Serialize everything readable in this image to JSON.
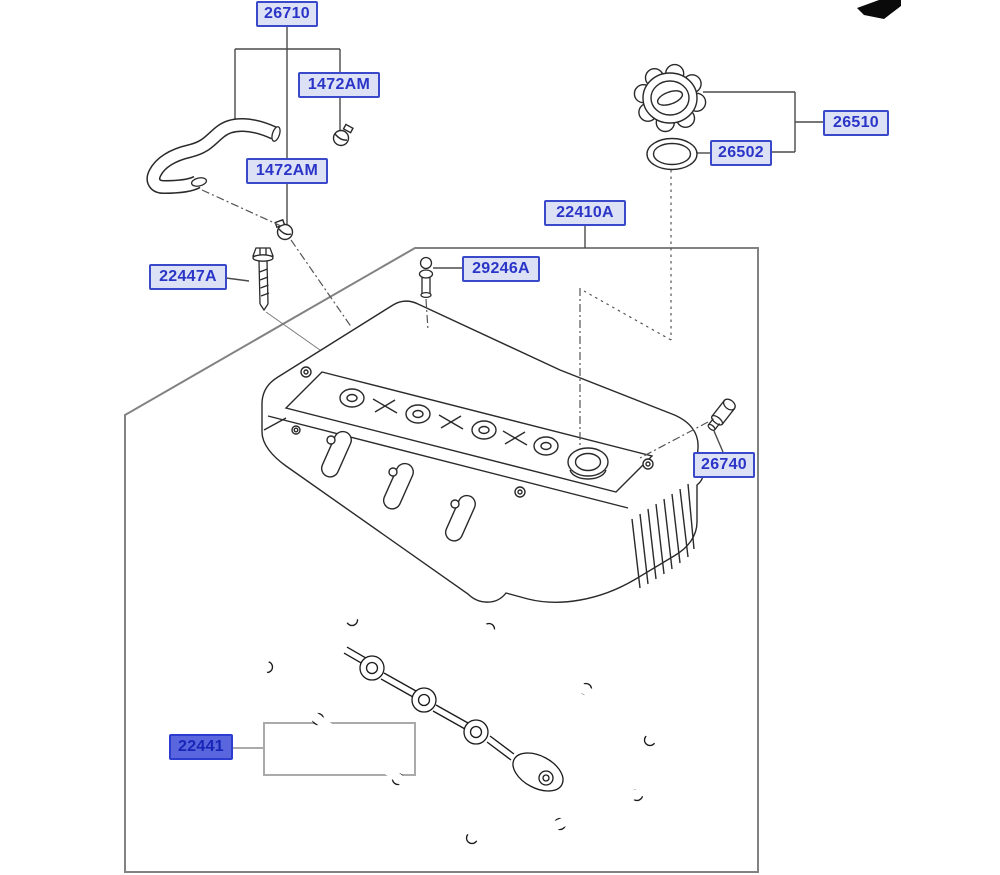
{
  "diagram": {
    "labels": [
      {
        "part_no": "26710",
        "selected": false
      },
      {
        "part_no": "1472AM",
        "selected": false
      },
      {
        "part_no": "1472AM",
        "selected": false
      },
      {
        "part_no": "26510",
        "selected": false
      },
      {
        "part_no": "26502",
        "selected": false
      },
      {
        "part_no": "22410A",
        "selected": false
      },
      {
        "part_no": "29246A",
        "selected": false
      },
      {
        "part_no": "22447A",
        "selected": false
      },
      {
        "part_no": "26740",
        "selected": false
      },
      {
        "part_no": "22441",
        "selected": true
      }
    ],
    "icons": {
      "direction_arrow": "front-direction-arrow"
    },
    "colors": {
      "label_text": "#2a35c8",
      "label_border": "#3a49c9",
      "label_fill": "#dce1f6",
      "selected_label_fill": "#5a66dd",
      "selected_label_text": "#1726b8",
      "leader_line": "#4a4a4a",
      "frame_border": "#828282",
      "bracket_gray": "#aaaaaa",
      "line_art": "#2a2a2a"
    }
  }
}
